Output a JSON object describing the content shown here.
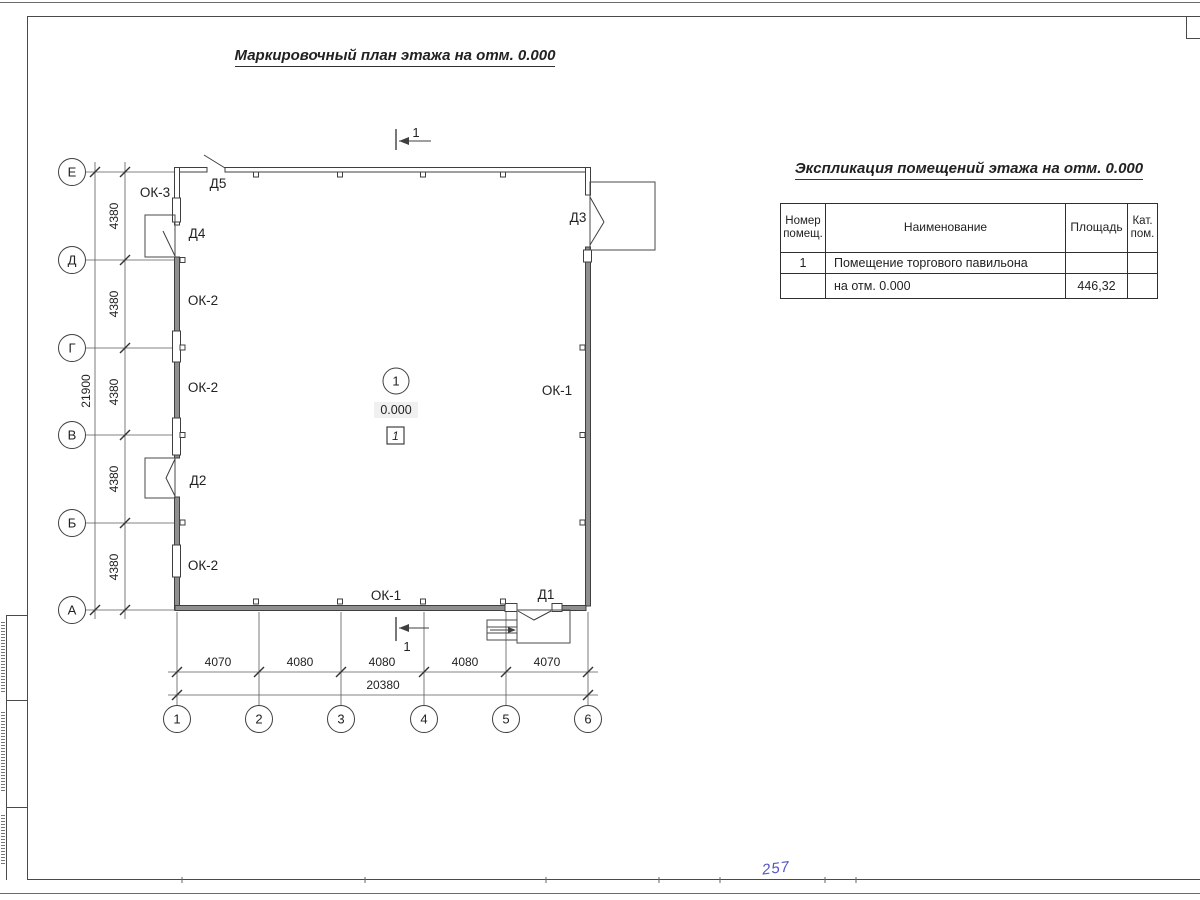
{
  "titles": {
    "plan": "Маркировочный план этажа на отм. 0.000",
    "table": "Экспликация помещений этажа на отм. 0.000"
  },
  "plan": {
    "axis_rows": [
      "Е",
      "Д",
      "Г",
      "В",
      "Б",
      "А"
    ],
    "axis_cols": [
      "1",
      "2",
      "3",
      "4",
      "5",
      "6"
    ],
    "dims_left_segments": [
      "4380",
      "4380",
      "4380",
      "4380",
      "4380"
    ],
    "dims_left_total": "21900",
    "dims_bottom_segments": [
      "4070",
      "4080",
      "4080",
      "4080",
      "4070"
    ],
    "dims_bottom_total": "20380",
    "door_labels": {
      "d1": "Д1",
      "d2": "Д2",
      "d3": "Д3",
      "d4": "Д4",
      "d5": "Д5"
    },
    "window_labels": {
      "ok1_right": "ОК-1",
      "ok1_bottom": "ОК-1",
      "ok2_top": "ОК-2",
      "ok2_mid": "ОК-2",
      "ok2_bottom": "ОК-2",
      "ok3": "ОК-3"
    },
    "room_tag": {
      "number": "1",
      "elevation": "0.000",
      "room_box": "1"
    },
    "section_marks": {
      "top": "1",
      "bottom": "1"
    }
  },
  "table": {
    "headers": {
      "num_line1": "Номер",
      "num_line2": "помещ.",
      "name": "Наименование",
      "area": "Площадь",
      "cat_line1": "Кат.",
      "cat_line2": "пом."
    },
    "rows": [
      {
        "num": "1",
        "name": "Помещение торгового павильона",
        "area": "",
        "cat": ""
      },
      {
        "num": "",
        "name": "на отм. 0.000",
        "area": "446,32",
        "cat": ""
      }
    ]
  },
  "annotations": {
    "handwritten_blue": "257"
  },
  "colors": {
    "ink": "#3f3f3f",
    "wall_fill": "#8f8f8f",
    "blue_pen": "#2929b8"
  }
}
